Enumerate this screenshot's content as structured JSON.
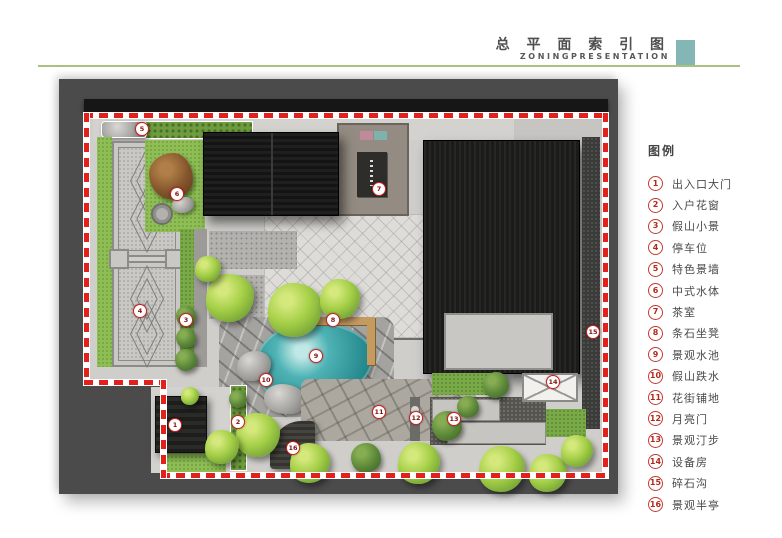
{
  "header": {
    "title": "总 平 面 索 引 图",
    "subtitle": "ZONINGPRESENTATION",
    "accent_color": "#84b6b6",
    "rule_color": "#a9c27f",
    "title_color": "#4f4f4f"
  },
  "legend": {
    "title": "图例",
    "items": [
      {
        "num": "1",
        "label": "出入口大门"
      },
      {
        "num": "2",
        "label": "入户花窗"
      },
      {
        "num": "3",
        "label": "假山小景"
      },
      {
        "num": "4",
        "label": "停车位"
      },
      {
        "num": "5",
        "label": "特色景墙"
      },
      {
        "num": "6",
        "label": "中式水体"
      },
      {
        "num": "7",
        "label": "茶室"
      },
      {
        "num": "8",
        "label": "条石坐凳"
      },
      {
        "num": "9",
        "label": "景观水池"
      },
      {
        "num": "10",
        "label": "假山跌水"
      },
      {
        "num": "11",
        "label": "花街铺地"
      },
      {
        "num": "12",
        "label": "月亮门"
      },
      {
        "num": "13",
        "label": "景观汀步"
      },
      {
        "num": "14",
        "label": "设备房"
      },
      {
        "num": "15",
        "label": "碎石沟"
      },
      {
        "num": "16",
        "label": "景观半亭"
      }
    ]
  },
  "plan": {
    "boundary_color": "#e2211c",
    "markers": [
      {
        "num": "1",
        "x": 115,
        "y": 345
      },
      {
        "num": "2",
        "x": 178,
        "y": 342
      },
      {
        "num": "3",
        "x": 126,
        "y": 240
      },
      {
        "num": "4",
        "x": 80,
        "y": 231
      },
      {
        "num": "5",
        "x": 82,
        "y": 49
      },
      {
        "num": "6",
        "x": 117,
        "y": 114
      },
      {
        "num": "7",
        "x": 319,
        "y": 109
      },
      {
        "num": "8",
        "x": 273,
        "y": 240
      },
      {
        "num": "9",
        "x": 256,
        "y": 276
      },
      {
        "num": "10",
        "x": 206,
        "y": 300
      },
      {
        "num": "11",
        "x": 319,
        "y": 332
      },
      {
        "num": "12",
        "x": 356,
        "y": 338
      },
      {
        "num": "13",
        "x": 394,
        "y": 339
      },
      {
        "num": "14",
        "x": 493,
        "y": 302
      },
      {
        "num": "15",
        "x": 533,
        "y": 252
      },
      {
        "num": "16",
        "x": 233,
        "y": 368
      }
    ]
  }
}
